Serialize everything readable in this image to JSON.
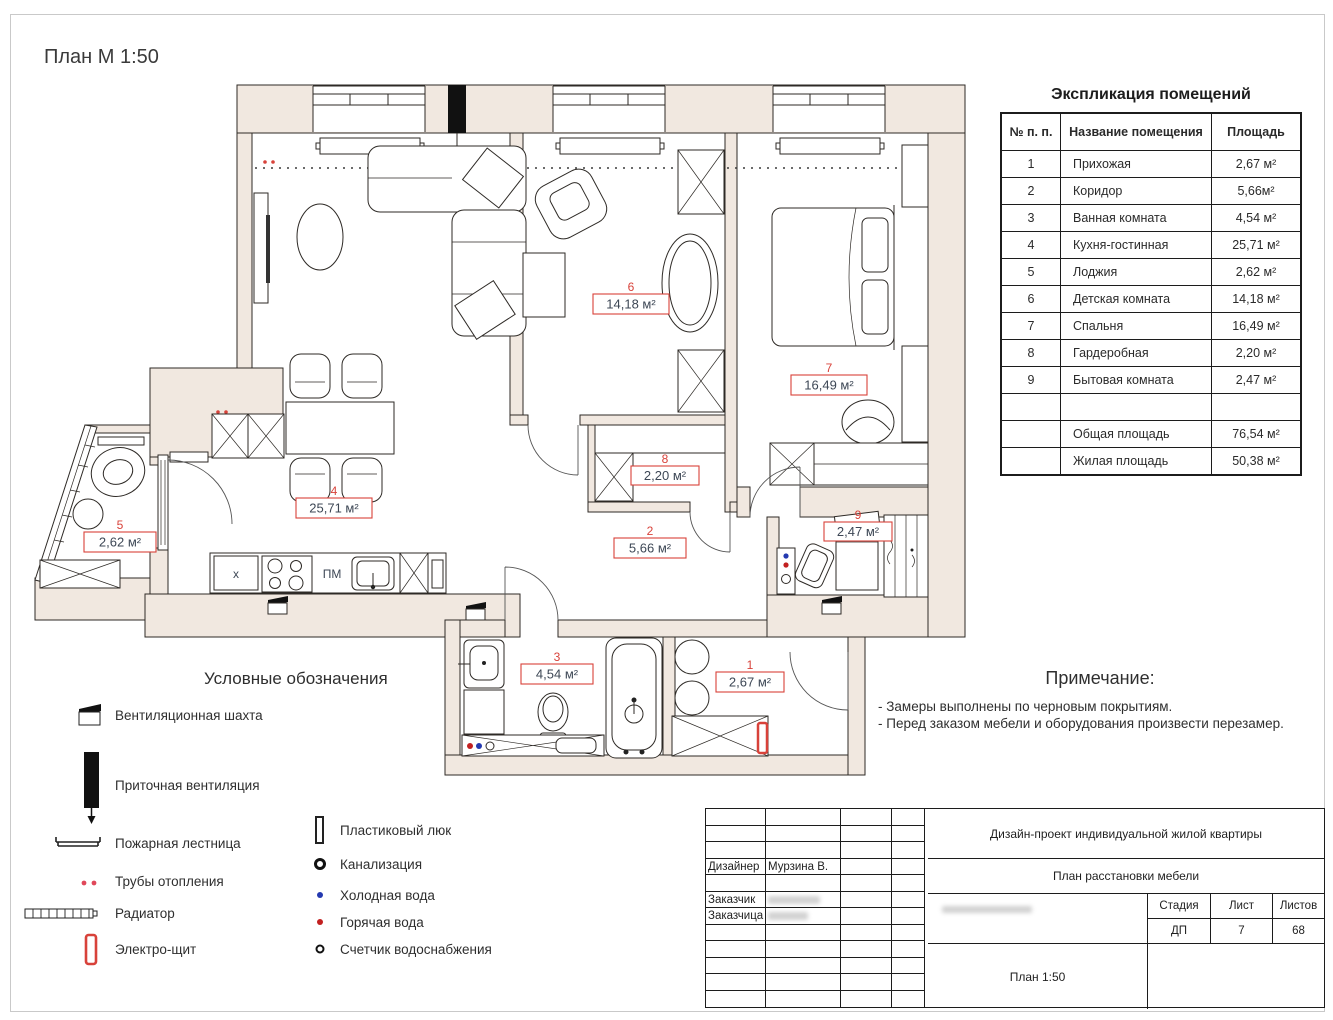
{
  "page": {
    "title": "План М 1:50"
  },
  "explication": {
    "title": "Экспликация помещений",
    "columns": [
      "№ п. п.",
      "Название помещения",
      "Площадь"
    ],
    "rows": [
      [
        "1",
        "Прихожая",
        "2,67 м²"
      ],
      [
        "2",
        "Коридор",
        "5,66м²"
      ],
      [
        "3",
        "Ванная комната",
        "4,54 м²"
      ],
      [
        "4",
        "Кухня-гостинная",
        "25,71 м²"
      ],
      [
        "5",
        "Лоджия",
        "2,62 м²"
      ],
      [
        "6",
        "Детская комната",
        "14,18 м²"
      ],
      [
        "7",
        "Спальня",
        "16,49 м²"
      ],
      [
        "8",
        "Гардеробная",
        "2,20 м²"
      ],
      [
        "9",
        "Бытовая комната",
        "2,47 м²"
      ]
    ],
    "totals": [
      [
        "Общая площадь",
        "76,54 м²"
      ],
      [
        "Жилая площадь",
        "50,38 м²"
      ]
    ]
  },
  "plan": {
    "rooms": [
      {
        "num": "1",
        "area": "2,67 м²"
      },
      {
        "num": "2",
        "area": "5,66 м²"
      },
      {
        "num": "3",
        "area": "4,54 м²"
      },
      {
        "num": "4",
        "area": "25,71 м²"
      },
      {
        "num": "5",
        "area": "2,62 м²"
      },
      {
        "num": "6",
        "area": "14,18 м²"
      },
      {
        "num": "7",
        "area": "16,49 м²"
      },
      {
        "num": "8",
        "area": "2,20 м²"
      },
      {
        "num": "9",
        "area": "2,47 м²"
      }
    ],
    "kitchen": {
      "dishwasher_label": "ПМ",
      "cabinet_label": "x"
    }
  },
  "legend": {
    "title": "Условные обозначения",
    "left": [
      "Вентиляционная шахта",
      "Приточная вентиляция",
      "Пожарная лестница",
      "Трубы отопления",
      "Радиатор",
      "Электро-щит"
    ],
    "right": [
      "Пластиковый люк",
      "Канализация",
      "Холодная вода",
      "Горячая вода",
      "Счетчик водоснабжения"
    ]
  },
  "notes": {
    "title": "Примечание:",
    "lines": [
      "- Замеры выполнены по черновым покрытиям.",
      "- Перед заказом мебели и оборудования произвести перезамер."
    ]
  },
  "titleblock": {
    "project": "Дизайн-проект индивидуальной жилой квартиры",
    "drawing": "План расстановки мебели",
    "designer_label": "Дизайнер",
    "designer_name": "Мурзина В.",
    "client1_label": "Заказчик",
    "client2_label": "Заказчица",
    "stage_label": "Стадия",
    "sheet_label": "Лист",
    "sheets_label": "Листов",
    "stage": "ДП",
    "sheet": "7",
    "sheets": "68",
    "scale": "План 1:50"
  },
  "colors": {
    "wall": "#f1e8e0",
    "accent_red": "#d8423a",
    "label_text": "#3d4755"
  }
}
